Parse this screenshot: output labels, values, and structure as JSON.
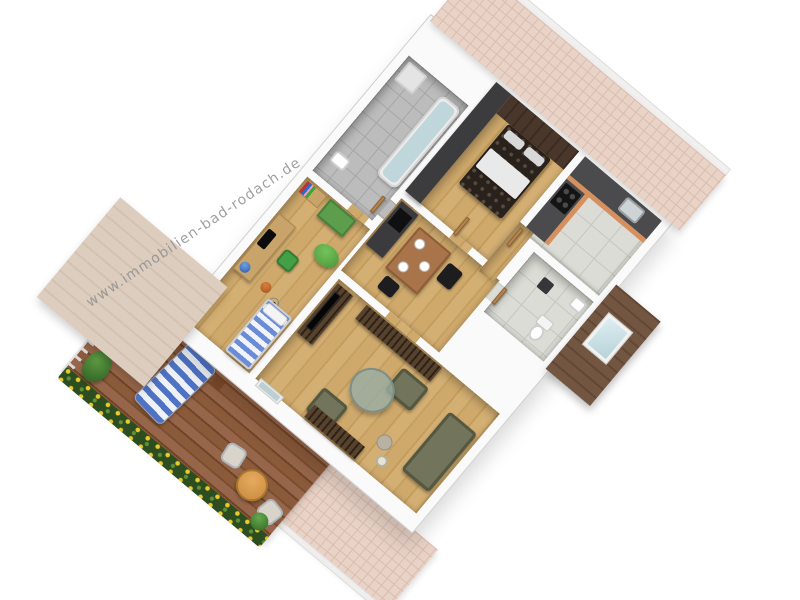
{
  "watermark": {
    "text": "www.immobilien-bad-rodach.de"
  },
  "scene": {
    "type": "3d-floorplan",
    "view": "isometric-birdseye",
    "plan_rotation_deg": 40,
    "background": "#ffffff"
  },
  "palette": {
    "wall_white": "#fafafa",
    "wood_floor": "#cba86a",
    "terrace_deck": "#84553a",
    "roof_pink": "#e9d3c7",
    "roof_beige": "#d8c9ba",
    "roof_wood_dark": "#6f5340",
    "bathroom_tile": "#bcbcbc",
    "kitchen_tile": "#dcdcd6",
    "dark_feature_wall": "#3c3c3e",
    "bedroom_sloped_wall": "#46342a",
    "cabinet_orange": "#d6905e",
    "counter_dark": "#4b4b4d",
    "accent_green": "#55a648",
    "sofa_olive": "#72755b",
    "zebra_wood": "#45341f",
    "bed_stripes_blue": "#6a8cd8",
    "lounger_stripes_blue": "#4e73c4",
    "flower_yellow": "#ecc929",
    "foliage_green": "#2c4d20",
    "water_blue": "#bfd6da",
    "skylight_glass": "#cfe3e8"
  },
  "rooms": [
    {
      "name": "bathroom",
      "items": [
        "bathtub",
        "shower",
        "washbasin"
      ]
    },
    {
      "name": "bedroom",
      "items": [
        "double-bed",
        "pillows",
        "sloped-wood-wall"
      ]
    },
    {
      "name": "kitchen",
      "items": [
        "counter-l-shape",
        "stove",
        "sink"
      ]
    },
    {
      "name": "wc",
      "items": [
        "toilet",
        "washbasin",
        "skylight"
      ]
    },
    {
      "name": "hallway",
      "items": [
        "dining-table",
        "plates",
        "black-chairs",
        "sideboard",
        "doors"
      ]
    },
    {
      "name": "childrens-room",
      "items": [
        "desk",
        "monitor",
        "globe",
        "desk-chair",
        "wardrobe",
        "bookshelf",
        "bean-bag",
        "basketball",
        "soccer-ball",
        "single-bed-striped"
      ]
    },
    {
      "name": "living-room",
      "items": [
        "tv-lowboard",
        "tv",
        "shelf-unit",
        "sofa",
        "armchair",
        "armchair",
        "coffee-table-glass",
        "side-table",
        "floor-lamp",
        "sideboard",
        "terrace-door"
      ]
    },
    {
      "name": "terrace",
      "items": [
        "wood-decking",
        "railing",
        "flower-boxes",
        "sun-lounger",
        "lounger-side-table",
        "bistro-table",
        "bistro-chair",
        "bistro-chair",
        "shrub",
        "plant"
      ]
    }
  ]
}
